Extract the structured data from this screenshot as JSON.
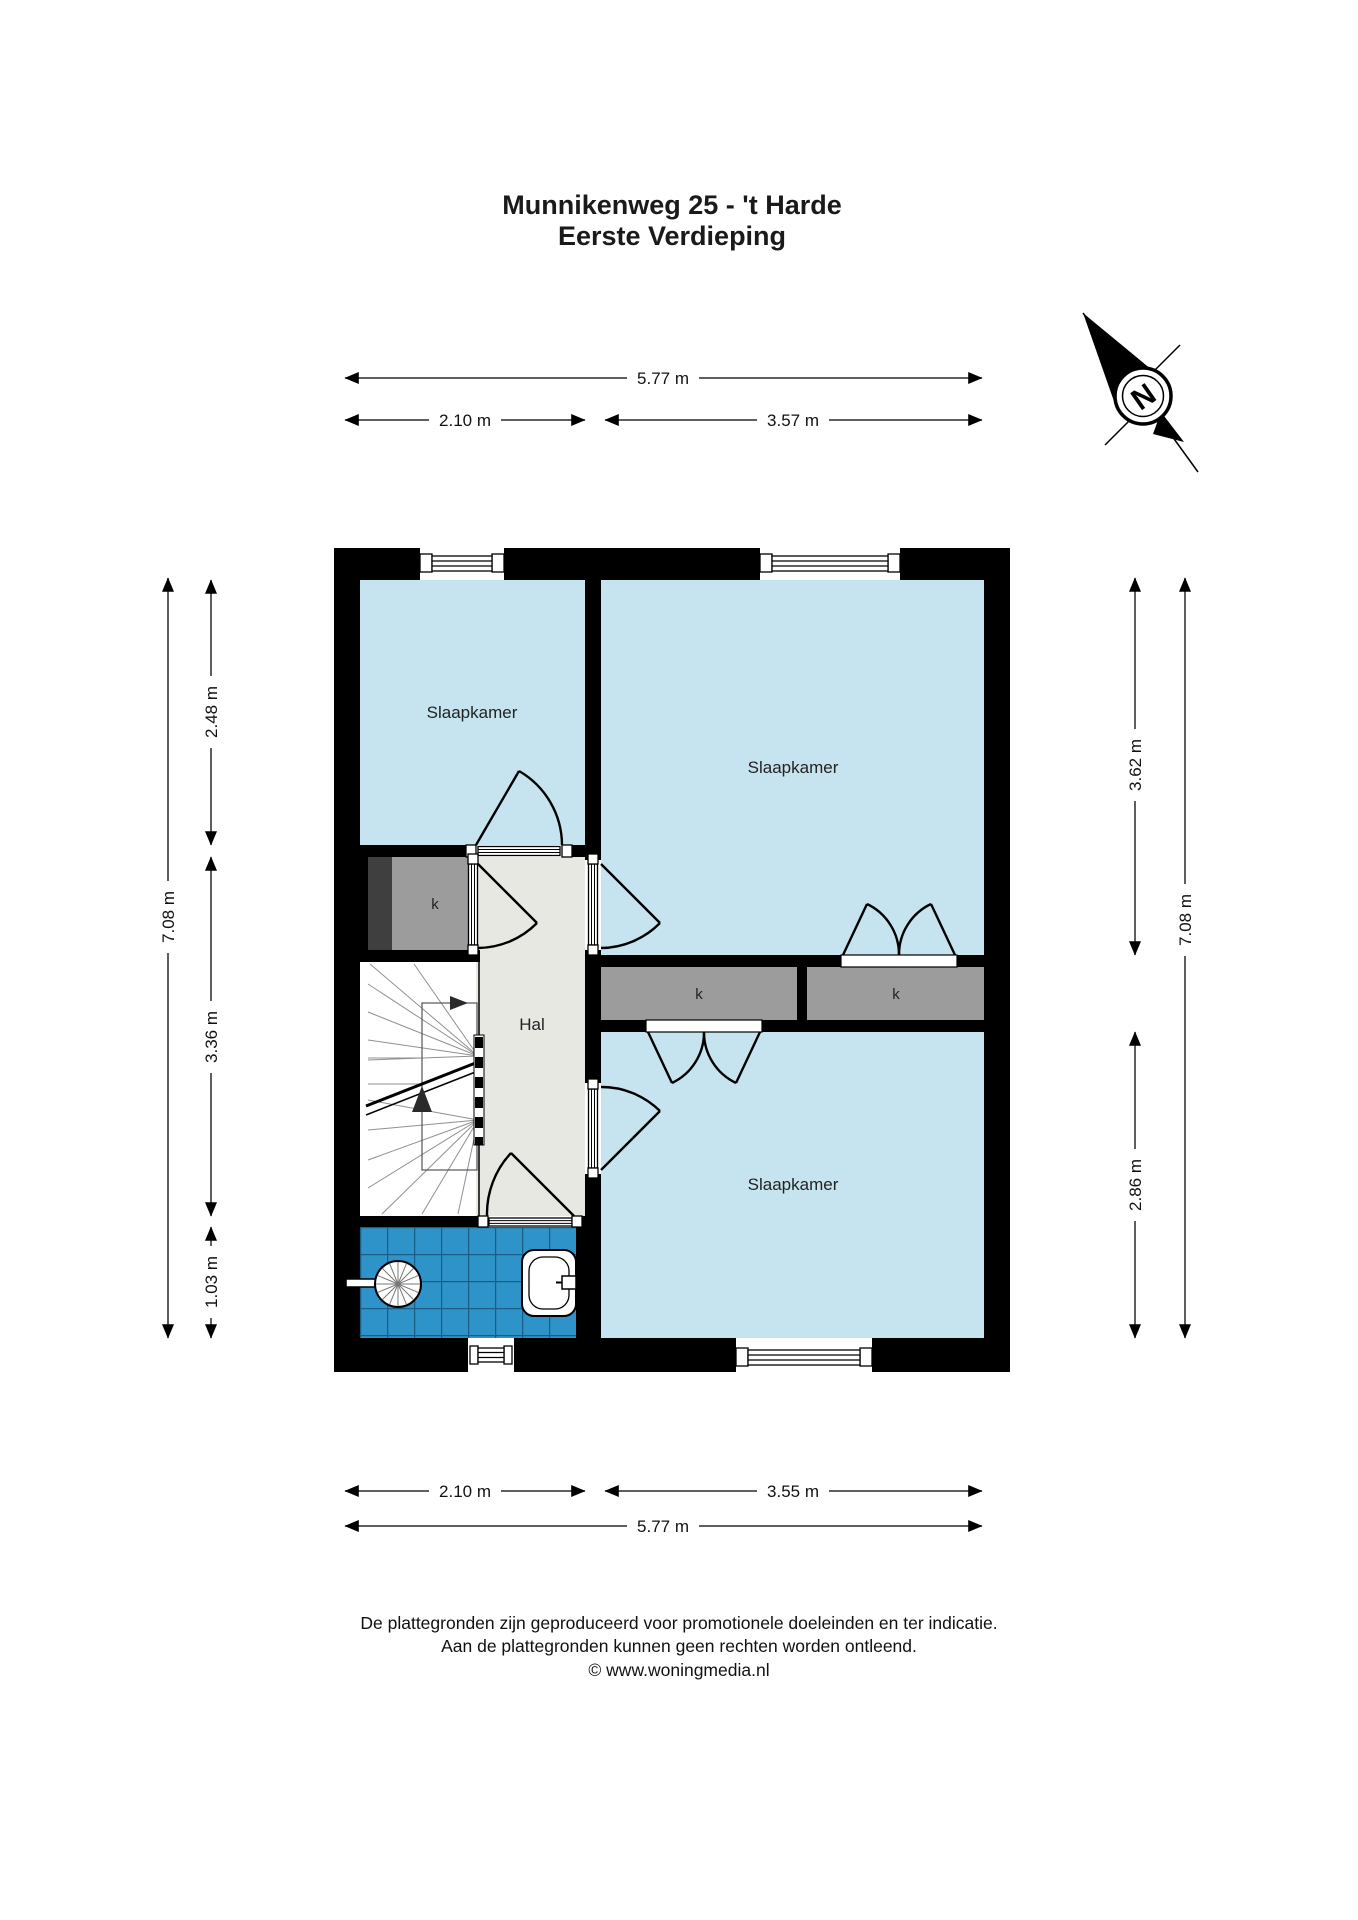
{
  "title": {
    "line1": "Munnikenweg 25 - 't Harde",
    "line2": "Eerste Verdieping"
  },
  "compass": {
    "north_label": "N"
  },
  "rooms": {
    "bedroom_top_left": "Slaapkamer",
    "bedroom_top_right": "Slaapkamer",
    "bedroom_bottom_right": "Slaapkamer",
    "hall": "Hal",
    "closet_left": "k",
    "closet_middle": "k",
    "closet_right": "k"
  },
  "dimensions": {
    "top_total": "5.77 m",
    "top_left": "2.10 m",
    "top_right": "3.57 m",
    "bottom_left": "2.10 m",
    "bottom_right": "3.55 m",
    "bottom_total": "5.77 m",
    "left_total": "7.08 m",
    "left_top": "2.48 m",
    "left_middle": "3.36 m",
    "left_bottom": "1.03 m",
    "right_top": "3.62 m",
    "right_total": "7.08 m",
    "right_bottom": "2.86 m"
  },
  "footer": {
    "line1": "De plattegronden zijn geproduceerd voor promotionele doeleinden en ter indicatie.",
    "line2": "Aan de plattegronden kunnen geen rechten worden ontleend.",
    "line3": "© www.woningmedia.nl"
  },
  "colors": {
    "room_fill": "#c6e4ef",
    "hall_fill": "#e8e8e3",
    "closet_fill": "#9c9c9c",
    "closet_dark": "#3f3f3f",
    "tile_fill": "#2e93c8",
    "tile_line": "#1a5d85",
    "wall": "#000000"
  }
}
